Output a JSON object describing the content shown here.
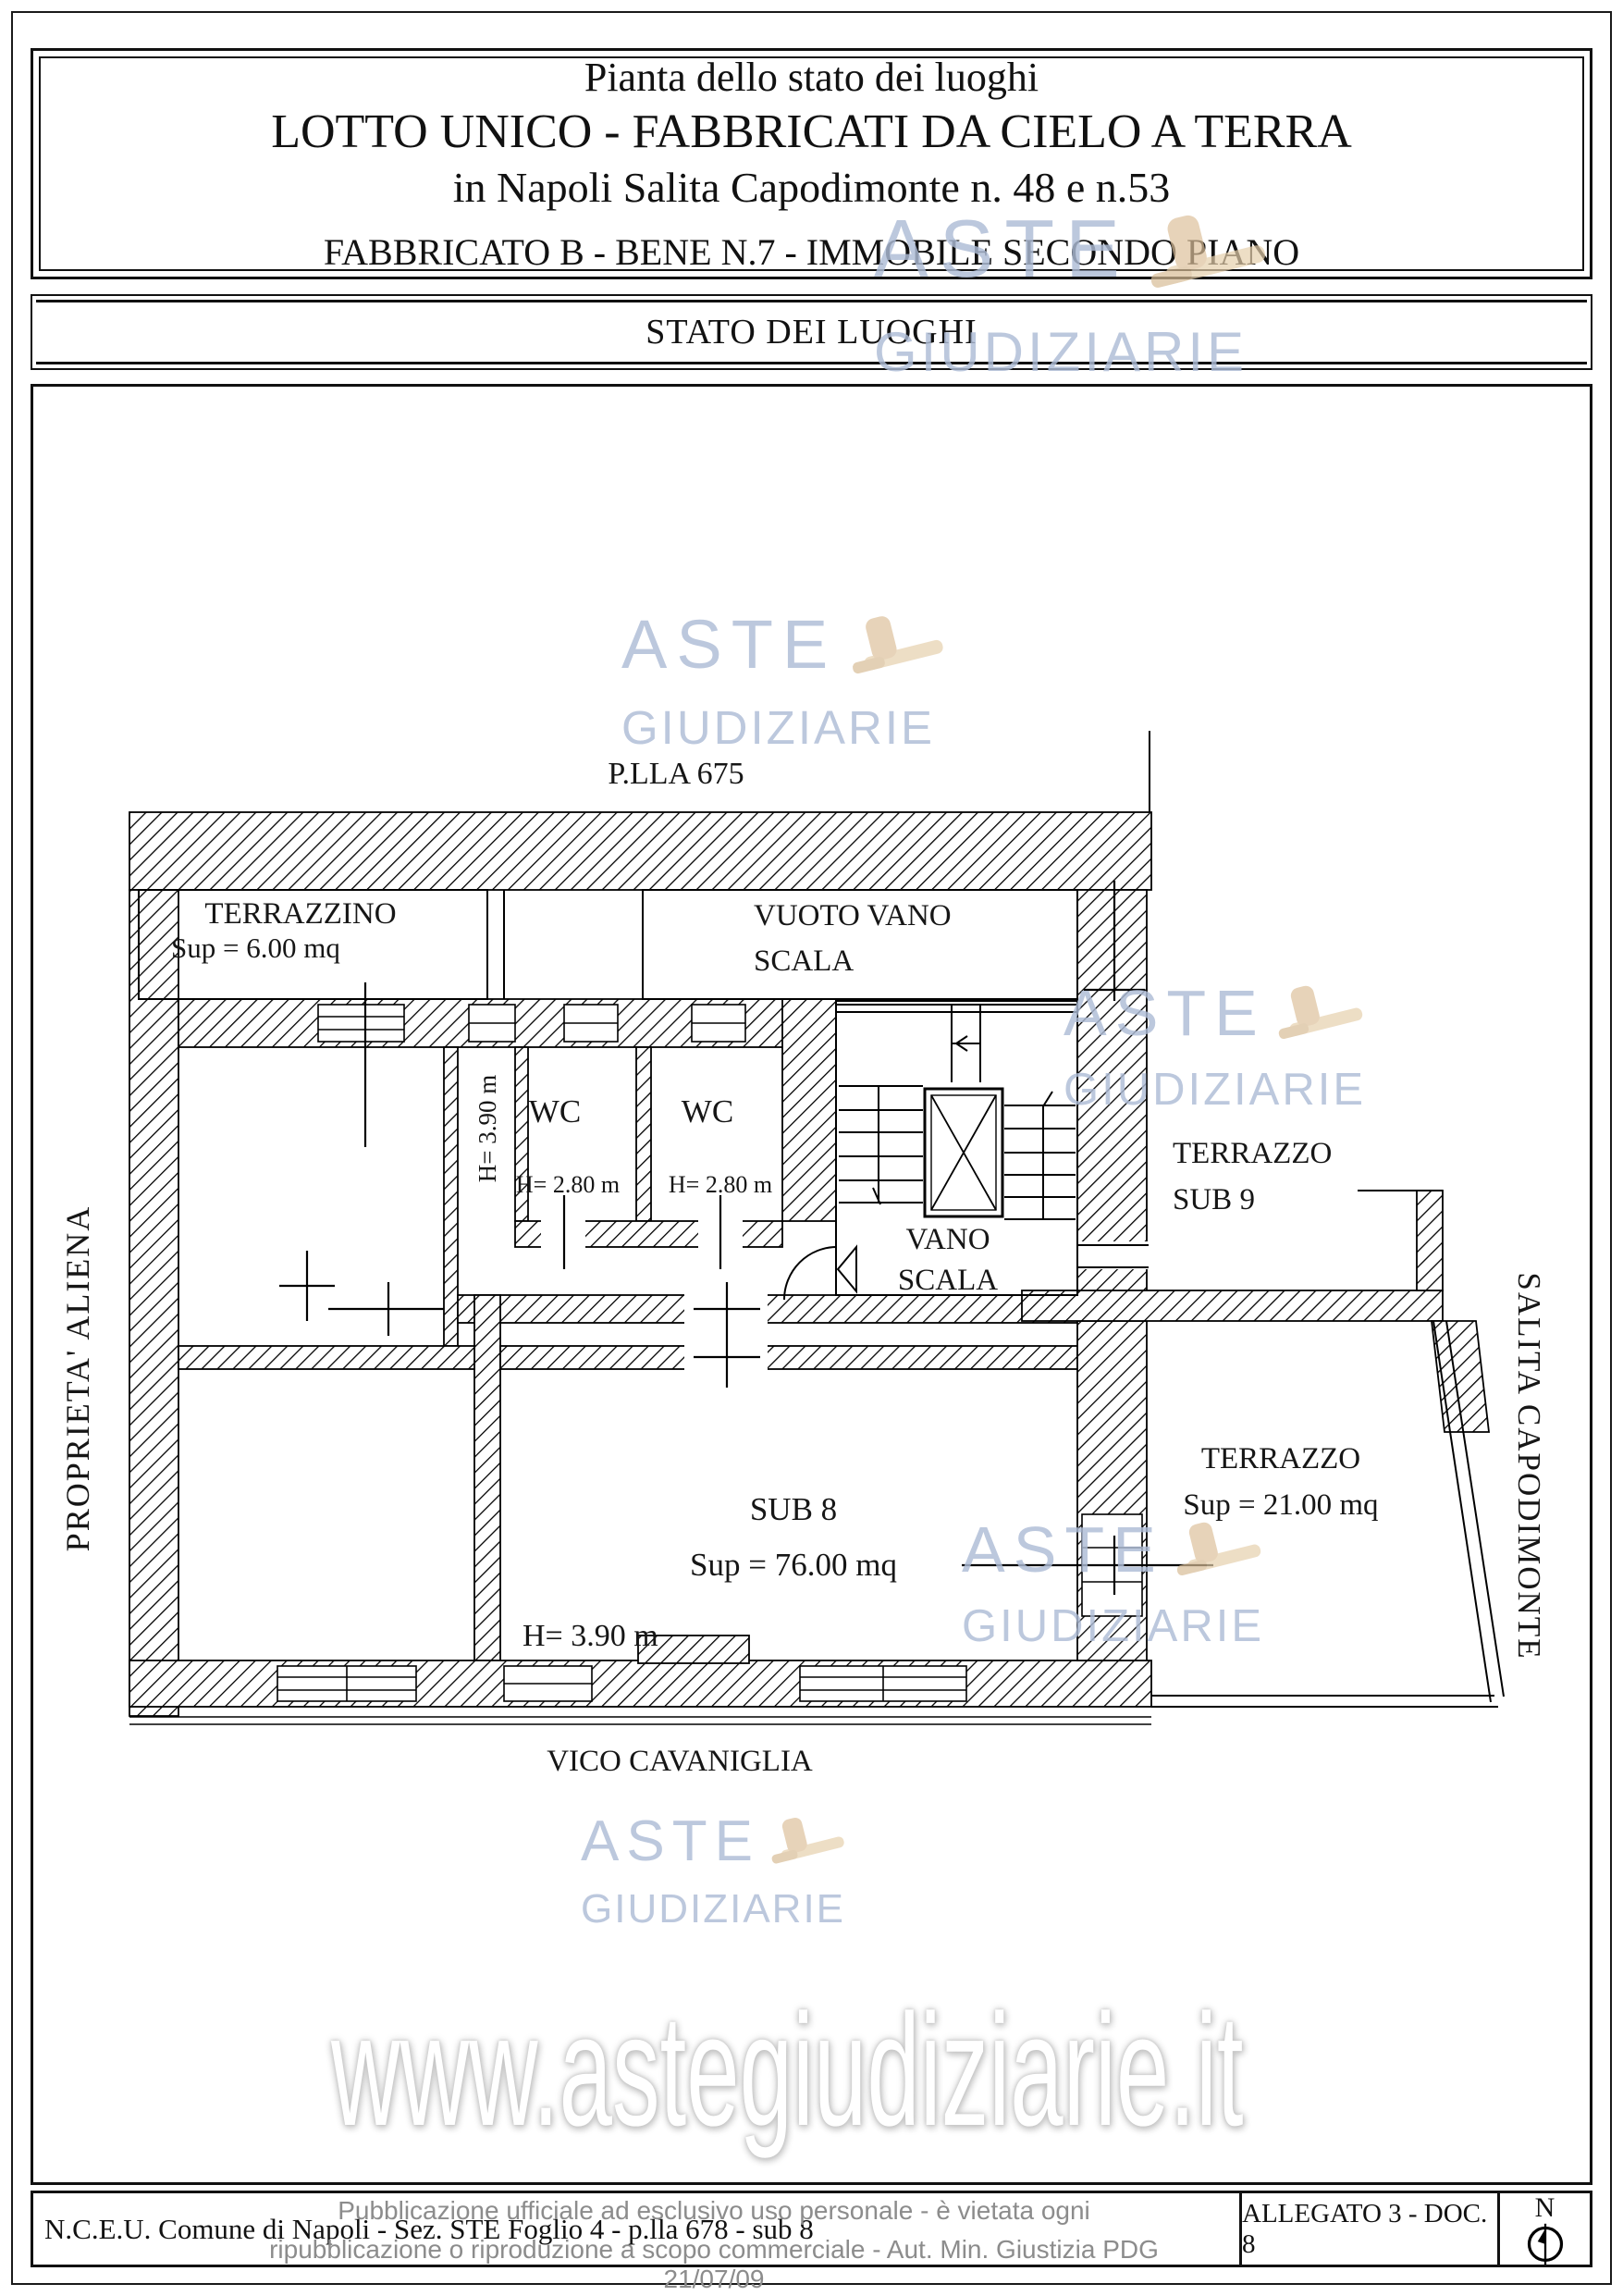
{
  "header": {
    "line1": "Pianta dello stato dei luoghi",
    "line2": "LOTTO UNICO - FABBRICATI DA CIELO A TERRA",
    "line3": "in Napoli Salita Capodimonte n. 48 e n.53",
    "line4": "FABBRICATO B - BENE N.7 - IMMOBILE SECONDO PIANO"
  },
  "section_bar": {
    "title": "STATO DEI LUOGHI"
  },
  "plan": {
    "parcel_label": "P.LLA 675",
    "rooms": {
      "terrazzino": {
        "name": "TERRAZZINO",
        "area": "Sup = 6.00 mq"
      },
      "vuoto_vano_scala": {
        "line1": "VUOTO VANO",
        "line2": "SCALA"
      },
      "wc1": {
        "name": "WC",
        "height": "H= 2.80 m"
      },
      "wc2": {
        "name": "WC",
        "height": "H= 2.80 m"
      },
      "corridor_height": "H= 3.90 m",
      "vano_scala": {
        "line1": "VANO",
        "line2": "SCALA"
      },
      "terrazzo_sub9": {
        "line1": "TERRAZZO",
        "line2": "SUB 9"
      },
      "sub8": {
        "name": "SUB 8",
        "area": "Sup = 76.00 mq",
        "height": "H= 3.90 m"
      },
      "terrazzo21": {
        "name": "TERRAZZO",
        "area": "Sup = 21.00 mq"
      }
    },
    "streets": {
      "left": "PROPRIETA' ALIENA",
      "right": "SALITA CAPODIMONTE",
      "bottom": "VICO CAVANIGLIA"
    }
  },
  "watermark": {
    "word1": "ASTE",
    "word2": "GIUDIZIARIE",
    "url": "www.astegiudiziarie.it",
    "accent_color": "#aebcd6",
    "gavel_color": "#dfc7a2"
  },
  "footer": {
    "left": "N.C.E.U. Comune di Napoli - Sez. STE Foglio 4 - p.lla 678 - sub 8",
    "allegato": "ALLEGATO 3 - DOC. 8",
    "north_label": "N",
    "disclaimer_line1": "Pubblicazione ufficiale ad esclusivo uso personale - è vietata ogni",
    "disclaimer_line2": "ripubblicazione o riproduzione a scopo commerciale - Aut. Min. Giustizia PDG 21/07/09"
  }
}
